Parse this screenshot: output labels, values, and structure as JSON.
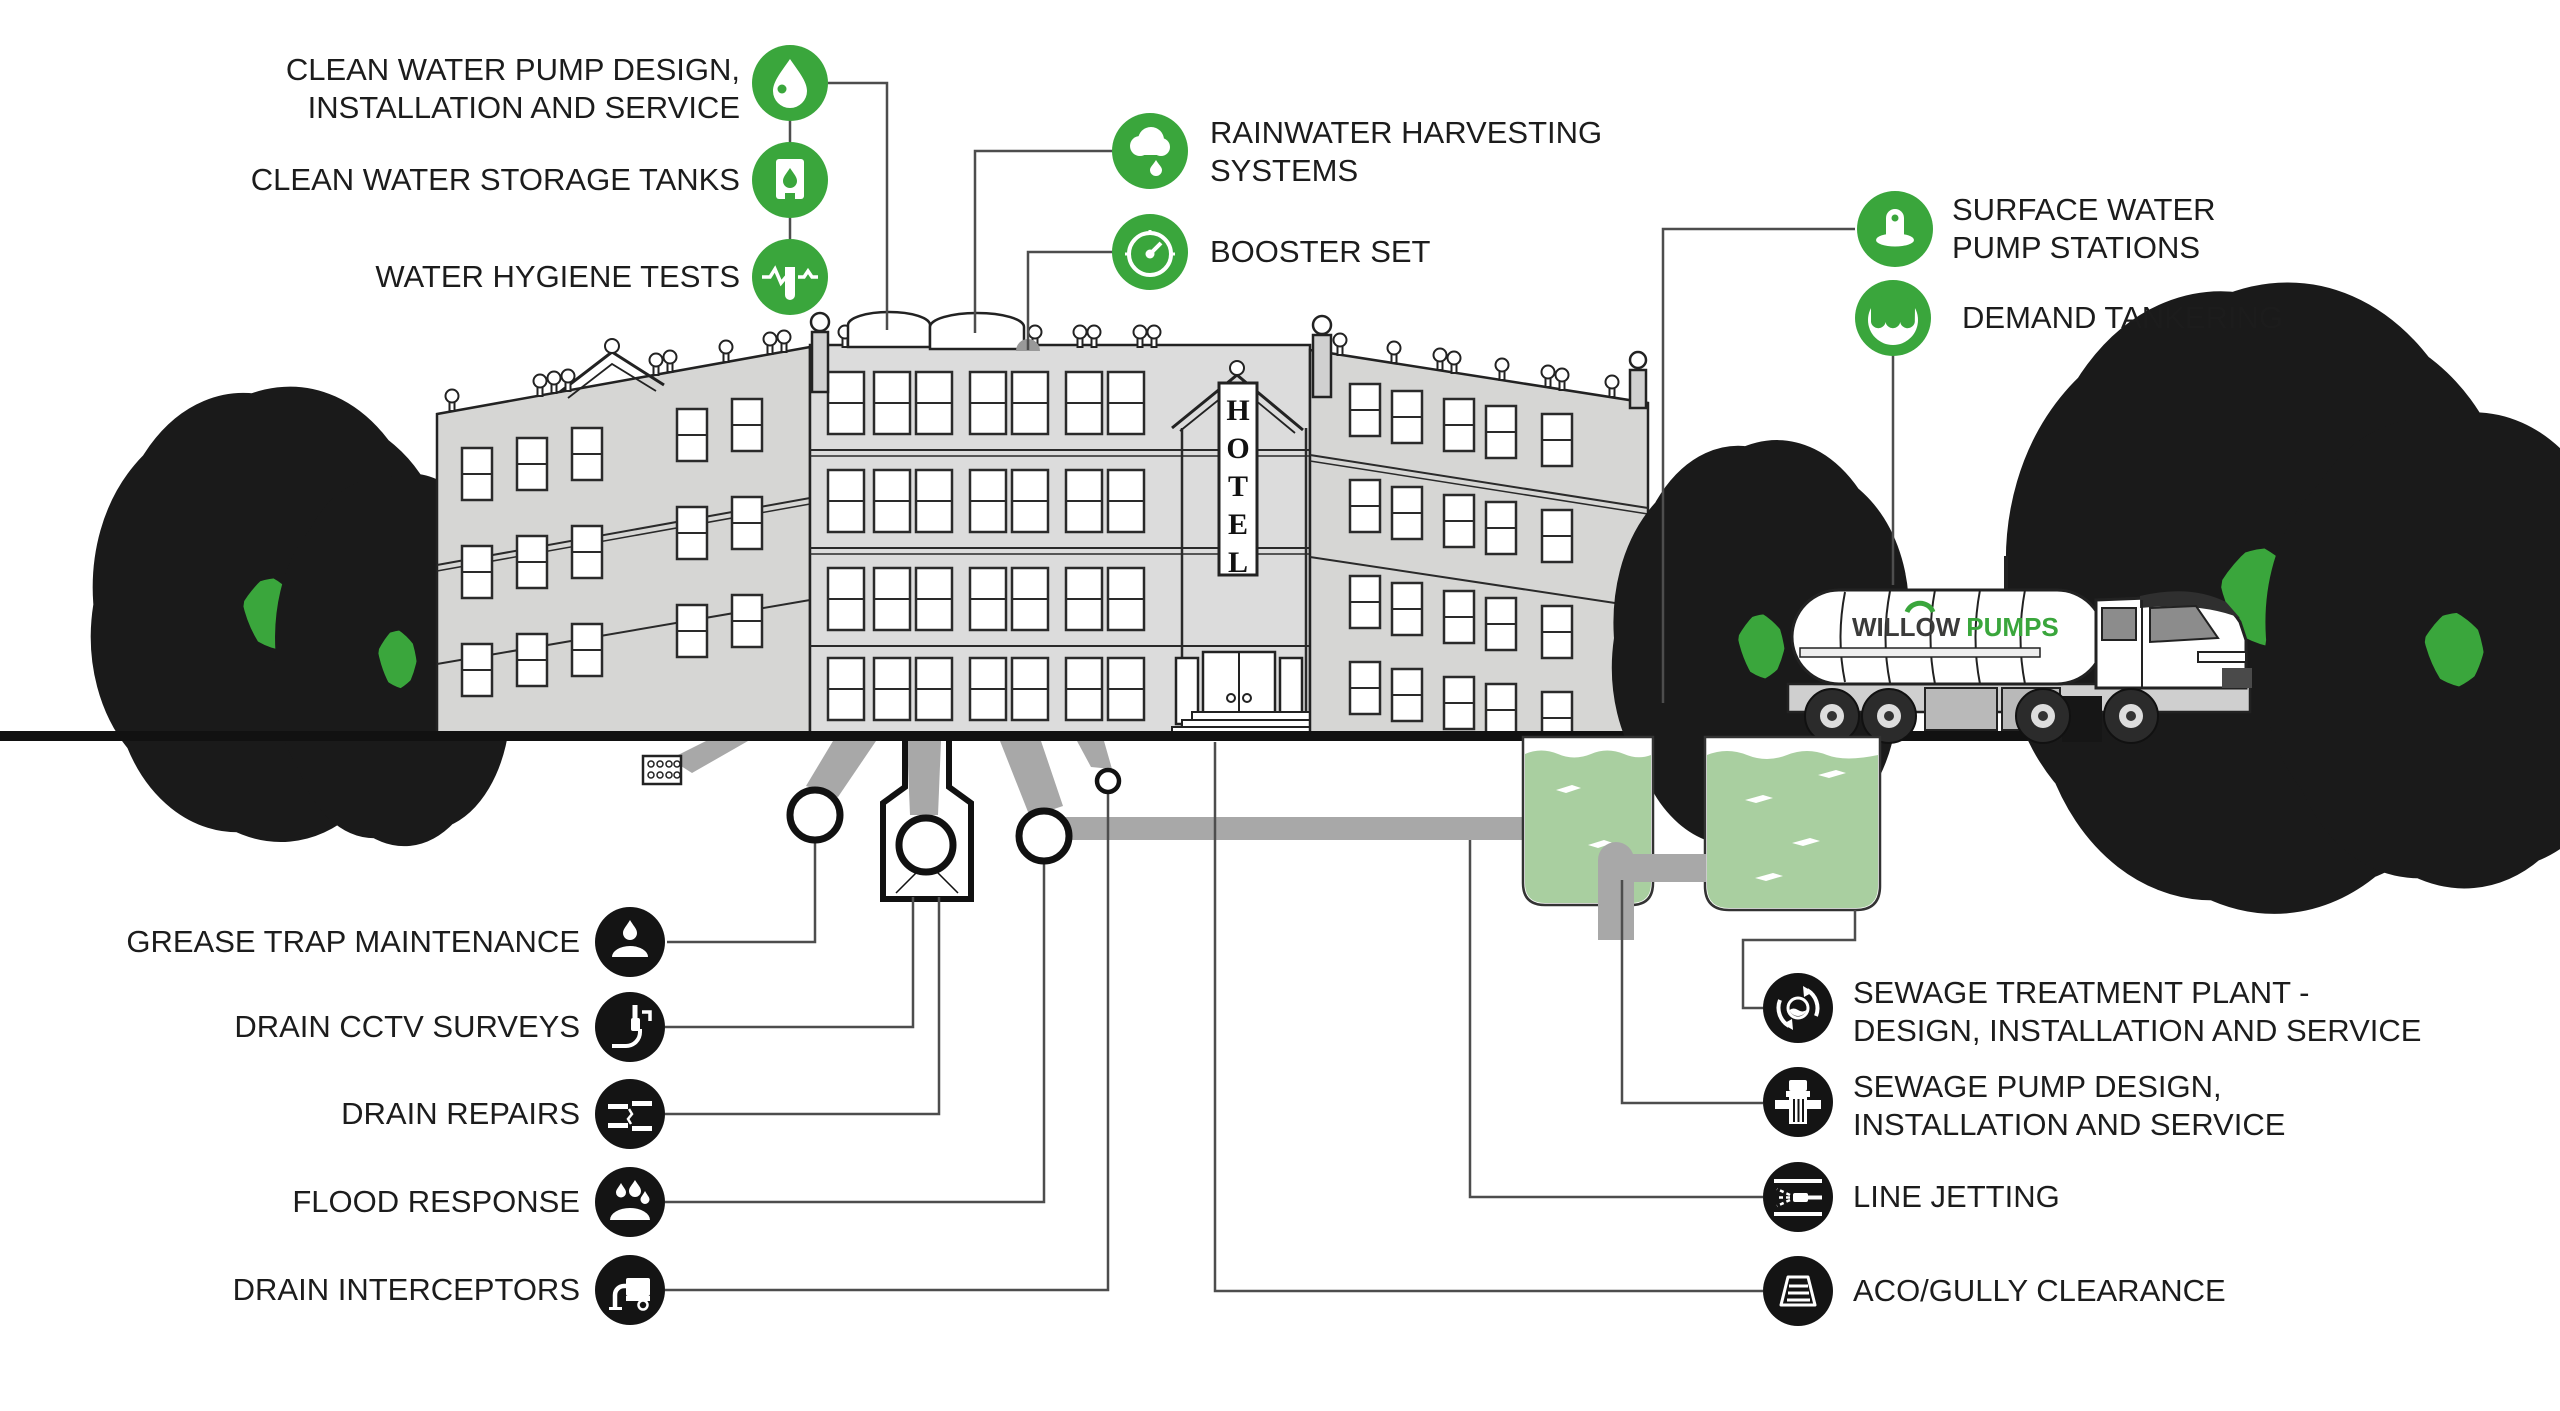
{
  "colors": {
    "accent_green": "#3aa63c",
    "tank_water_green": "#a9cfa0",
    "pipe_gray": "#a8a8a8",
    "building_gray": "#dcdcdc",
    "ink": "#1c1c1c"
  },
  "labels": {
    "clean_water_pump_1": "CLEAN WATER PUMP DESIGN,",
    "clean_water_pump_2": "INSTALLATION AND SERVICE",
    "clean_water_storage": "CLEAN WATER STORAGE TANKS",
    "water_hygiene": "WATER HYGIENE TESTS",
    "rainwater_1": "RAINWATER HARVESTING",
    "rainwater_2": "SYSTEMS",
    "booster": "BOOSTER SET",
    "surface_1": "SURFACE WATER",
    "surface_2": "PUMP STATIONS",
    "demand": "DEMAND TANKERING",
    "grease": "GREASE TRAP MAINTENANCE",
    "cctv": "DRAIN CCTV SURVEYS",
    "repairs": "DRAIN REPAIRS",
    "flood": "FLOOD RESPONSE",
    "interceptors": "DRAIN INTERCEPTORS",
    "stp_1": "SEWAGE TREATMENT PLANT -",
    "stp_2": "DESIGN, INSTALLATION AND SERVICE",
    "sewage_pump_1": "SEWAGE PUMP DESIGN,",
    "sewage_pump_2": "INSTALLATION AND SERVICE",
    "line_jetting": "LINE JETTING",
    "aco": "ACO/GULLY CLEARANCE"
  },
  "truck": {
    "brand_1": "WILLOW",
    "brand_2": "PUMPS"
  },
  "hotel_sign": {
    "l0": "H",
    "l1": "O",
    "l2": "T",
    "l3": "E",
    "l4": "L"
  },
  "icon_names": {
    "water-drop-icon": "clean water pump",
    "storage-tank-icon": "clean water storage",
    "hygiene-test-icon": "water hygiene tests",
    "rain-cloud-icon": "rainwater harvesting",
    "gauge-icon": "booster set",
    "surface-pump-icon": "surface water pump stations",
    "tanker-water-icon": "demand tankering",
    "grease-trap-icon": "grease trap maintenance",
    "cctv-camera-icon": "drain cctv surveys",
    "pipe-repair-icon": "drain repairs",
    "flood-drops-icon": "flood response",
    "interceptor-truck-icon": "drain interceptors",
    "treatment-cycle-icon": "sewage treatment plant",
    "sewage-pump-icon": "sewage pump",
    "jetting-nozzle-icon": "line jetting",
    "gully-grate-icon": "aco/gully clearance"
  }
}
